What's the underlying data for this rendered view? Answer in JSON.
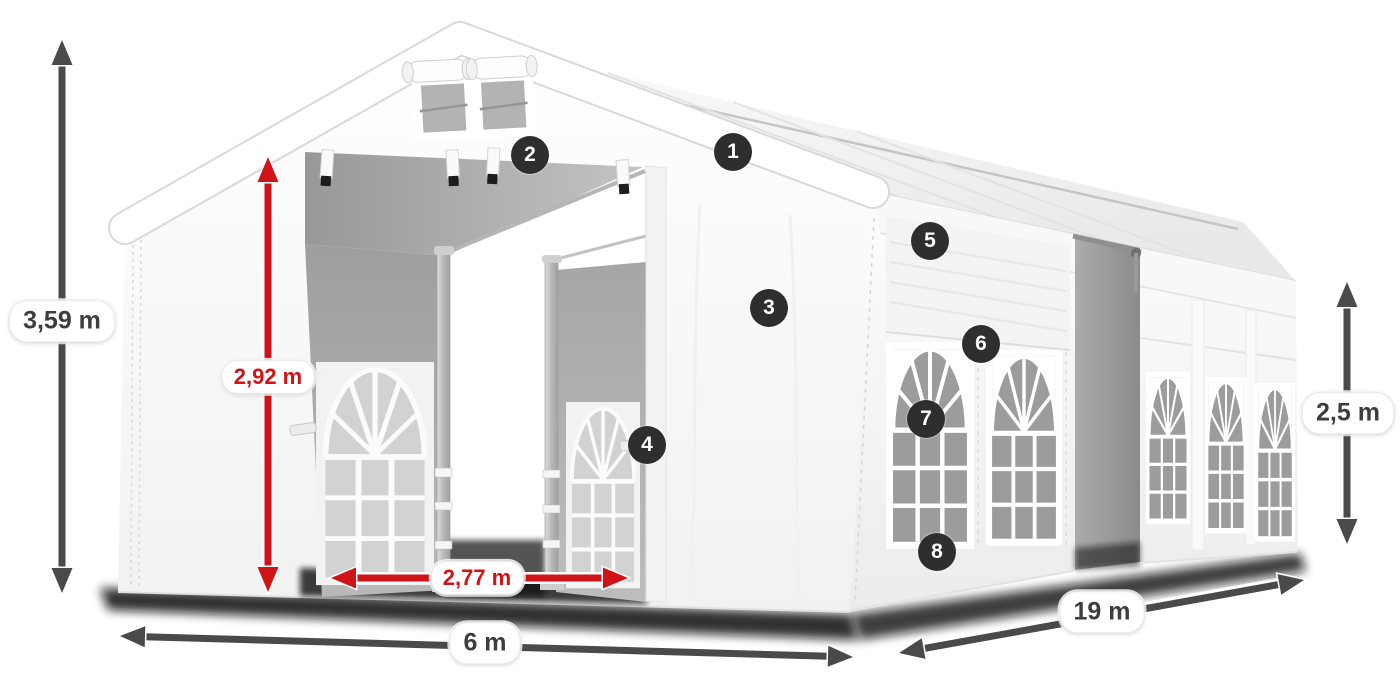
{
  "illustration": {
    "subject": "white-party-tent-with-open-front-doors",
    "colors": {
      "accent_red": "#d01317",
      "arrow_gray": "#4a4a4a",
      "marker_bg": "#2e2e2e",
      "marker_text": "#ffffff",
      "pill_bg": "#ffffff",
      "pill_text": "#3d3d3d",
      "tent_white": "#ffffff",
      "interior_gray": "#a8a8a8"
    }
  },
  "dimensions": {
    "total_height": "3,59 m",
    "entrance_height": "2,92 m",
    "entrance_width": "2,77 m",
    "front_width": "6 m",
    "length": "19 m",
    "side_height": "2,5 m"
  },
  "markers": [
    {
      "number": "1"
    },
    {
      "number": "2"
    },
    {
      "number": "3"
    },
    {
      "number": "4"
    },
    {
      "number": "5"
    },
    {
      "number": "6"
    },
    {
      "number": "7"
    },
    {
      "number": "8"
    }
  ]
}
